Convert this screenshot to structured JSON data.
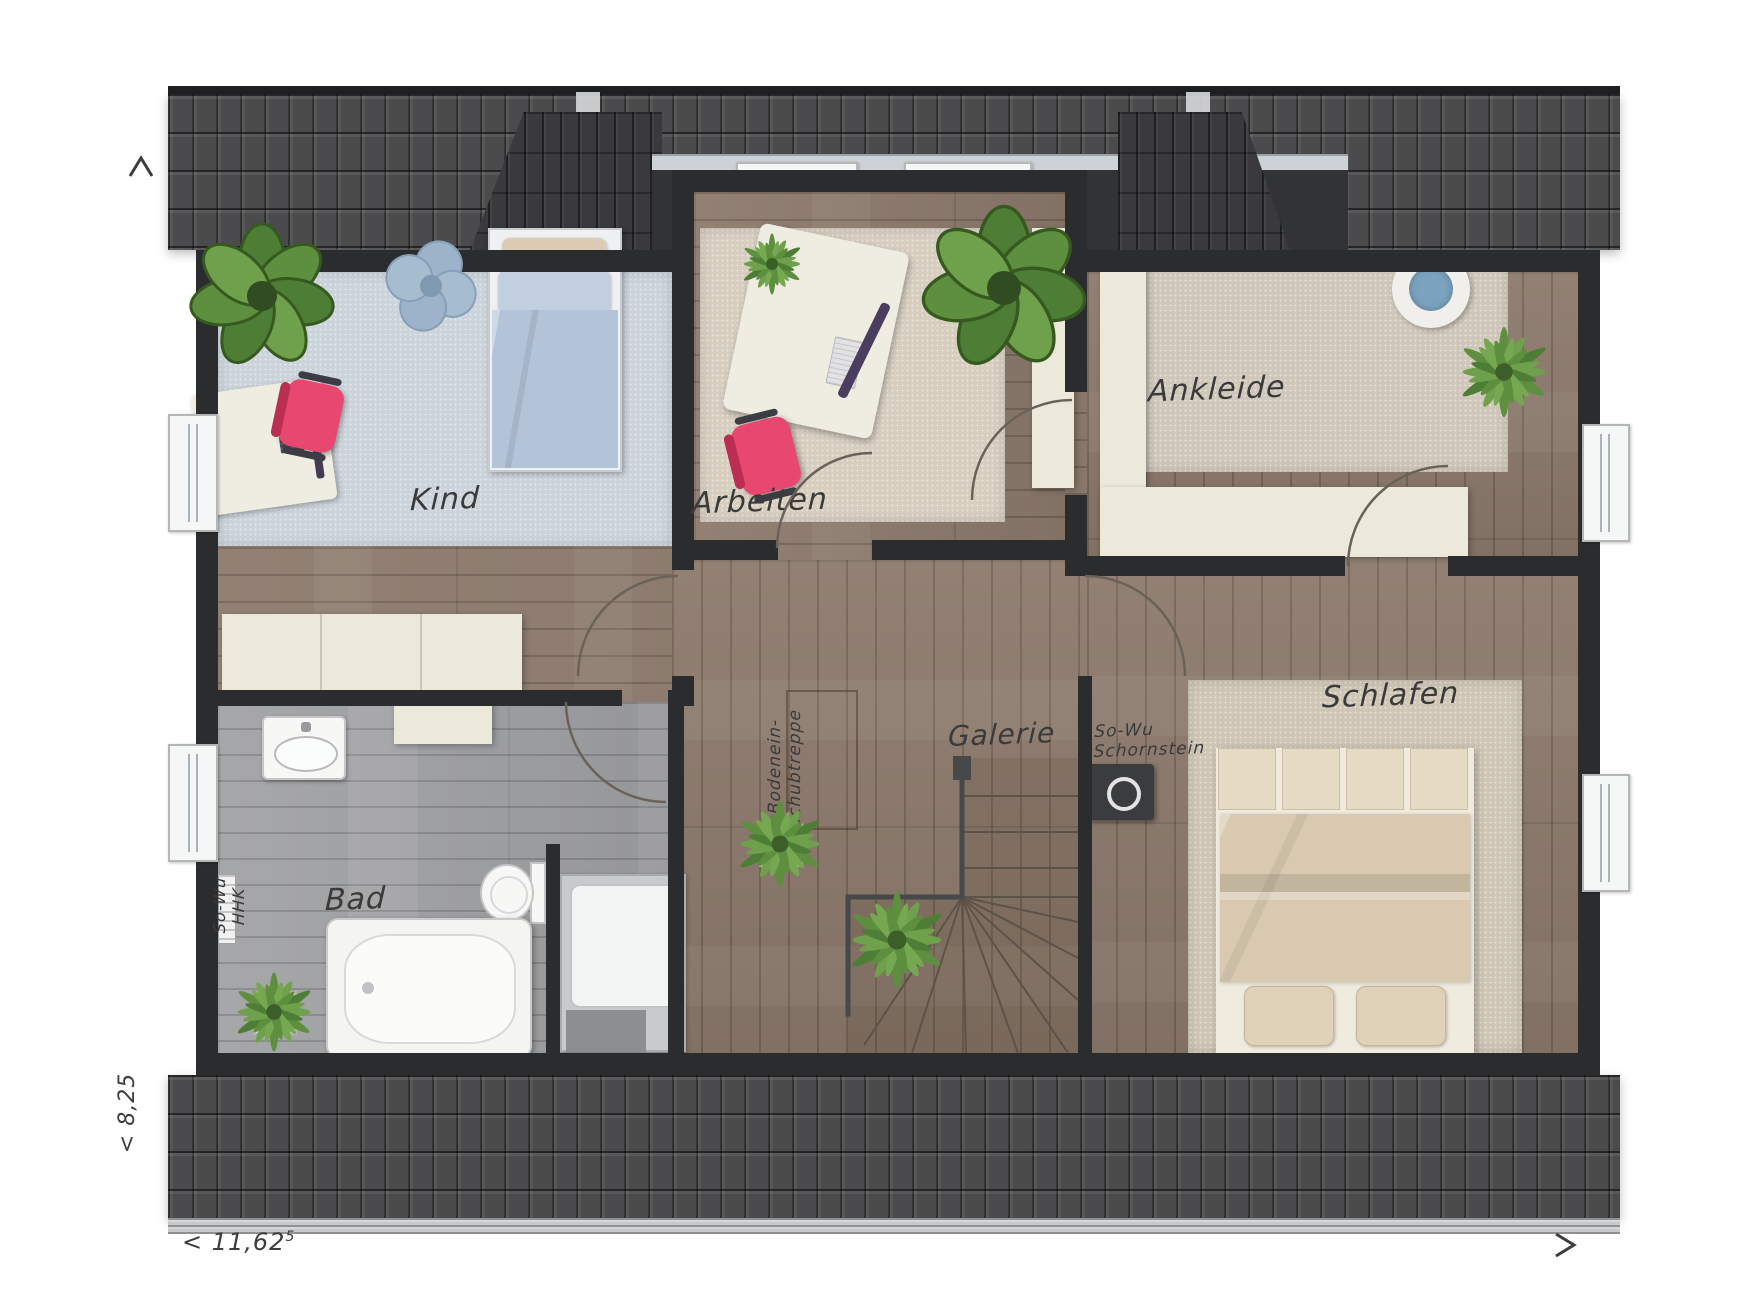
{
  "rooms": {
    "kind": "Kind",
    "arbeiten": "Arbeiten",
    "ankleide": "Ankleide",
    "schlafen": "Schlafen",
    "bad": "Bad",
    "galerie": "Galerie"
  },
  "annotations": {
    "loft_line1": "Bodenein-",
    "loft_line2": "schubtreppe",
    "chimney_line1": "So-Wu",
    "chimney_line2": "Schornstein",
    "hhk_line1": "So-Wu",
    "hhk_line2": "HHK"
  },
  "dimensions": {
    "width_value": "< 11,62",
    "width_superscript": "5",
    "depth_value": "< 8,25"
  },
  "colors": {
    "wall": "#2b2c2e",
    "roof": "#4b4b4d",
    "roof_dark": "#3a3a3c",
    "wood": "#8c7a6c",
    "wood_gray": "#9fa0a2",
    "carpet_kind": "#ccd4db",
    "carpet_arbeiten": "#d7cec0",
    "carpet_ankleide": "#cfc8ba",
    "carpet_schlafen": "#cfc6b6",
    "furniture_cream": "#ece8da",
    "chair_pink": "#e8476f",
    "plant_green": "#5d8f3f",
    "bed_blue": "#b3c4d8",
    "gutter": "#c7c9cb"
  }
}
